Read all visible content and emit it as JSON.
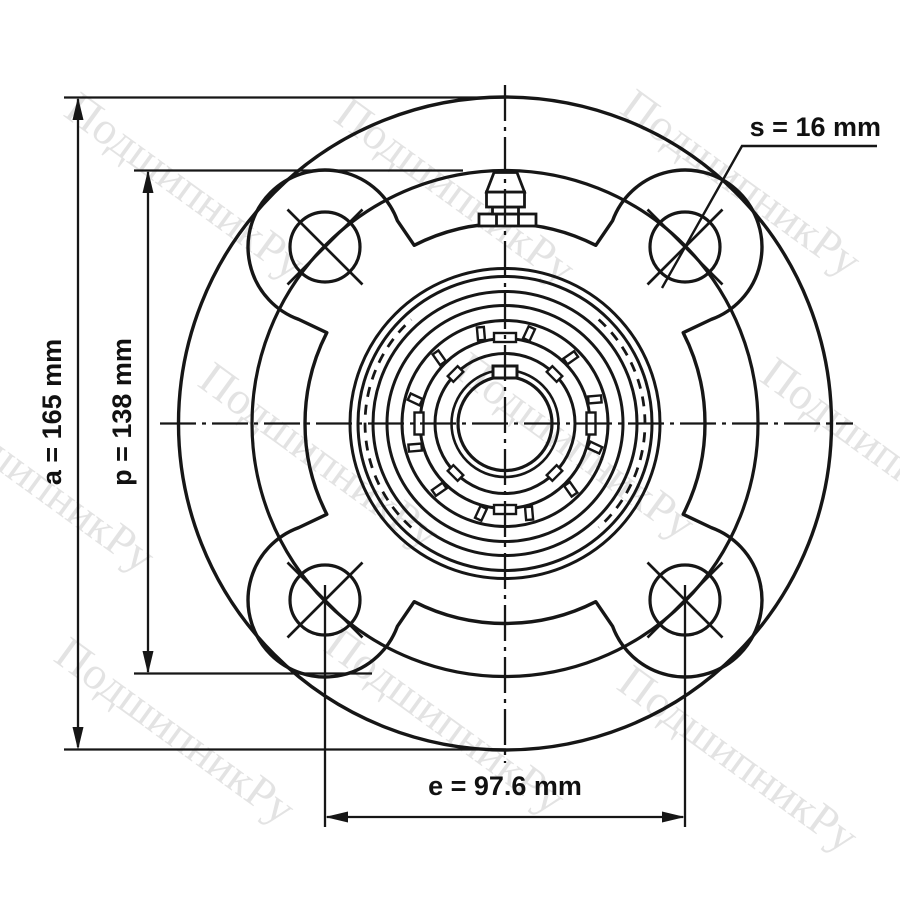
{
  "watermark": {
    "text": "ПодшипникРу"
  },
  "colors": {
    "line": "#161616",
    "watermark": "#e3e3e3",
    "background": "#ffffff"
  },
  "dimensions": {
    "s": {
      "param": "s",
      "value": "16",
      "unit": "mm",
      "label": "s = 16 mm"
    },
    "a": {
      "param": "a",
      "value": "165",
      "unit": "mm",
      "label": "a = 165 mm"
    },
    "p": {
      "param": "p",
      "value": "138",
      "unit": "mm",
      "label": "p = 138 mm"
    },
    "e": {
      "param": "e",
      "value": "97.6",
      "unit": "mm",
      "label": "e = 97.6 mm"
    }
  }
}
